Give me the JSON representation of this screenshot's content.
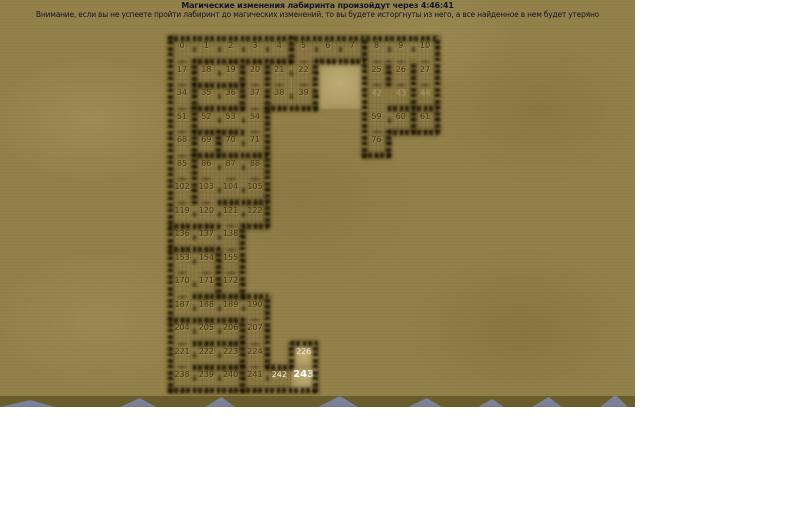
{
  "header": {
    "timer_line": "Магические изменения лабиринта произойдут через 4:46:41",
    "warning_line": "Внимание, если вы не успеете пройти лабиринт до магических изменений, то вы будете исторгнуты из него, а все найденное в нем будет утеряно"
  },
  "theme": {
    "sand": "#93814a",
    "light": "#ae9c64",
    "num": "#43350f",
    "faint": "#9c8a52",
    "wnum": "#efe9d6",
    "band": "#6a5d2c",
    "peak": "#7d85a8"
  },
  "maze": {
    "grid": {
      "origin_x": 170,
      "origin_y": 38,
      "cell_w": 24.3,
      "cell_h": 23.5,
      "cols": 11,
      "rows": 15
    },
    "light_areas": [
      {
        "r": 1,
        "c": 6,
        "w": 2,
        "h": 2
      },
      {
        "r": 13,
        "c": 5,
        "w": 1,
        "h": 1
      },
      {
        "r": 14,
        "c": 5,
        "w": 1,
        "h": 1
      }
    ],
    "cells": [
      {
        "n": "0",
        "r": 0,
        "c": 0,
        "s": "n"
      },
      {
        "n": "1",
        "r": 0,
        "c": 1,
        "s": "n"
      },
      {
        "n": "2",
        "r": 0,
        "c": 2,
        "s": "n"
      },
      {
        "n": "3",
        "r": 0,
        "c": 3,
        "s": "n"
      },
      {
        "n": "4",
        "r": 0,
        "c": 4,
        "s": "n"
      },
      {
        "n": "5",
        "r": 0,
        "c": 5,
        "s": "n"
      },
      {
        "n": "6",
        "r": 0,
        "c": 6,
        "s": "n"
      },
      {
        "n": "7",
        "r": 0,
        "c": 7,
        "s": "n"
      },
      {
        "n": "8",
        "r": 0,
        "c": 8,
        "s": "n"
      },
      {
        "n": "9",
        "r": 0,
        "c": 9,
        "s": "n"
      },
      {
        "n": "10",
        "r": 0,
        "c": 10,
        "s": "n"
      },
      {
        "n": "17",
        "r": 1,
        "c": 0,
        "s": "n"
      },
      {
        "n": "18",
        "r": 1,
        "c": 1,
        "s": "n"
      },
      {
        "n": "19",
        "r": 1,
        "c": 2,
        "s": "n"
      },
      {
        "n": "20",
        "r": 1,
        "c": 3,
        "s": "n"
      },
      {
        "n": "21",
        "r": 1,
        "c": 4,
        "s": "n"
      },
      {
        "n": "22",
        "r": 1,
        "c": 5,
        "s": "n"
      },
      {
        "n": "25",
        "r": 1,
        "c": 8,
        "s": "n"
      },
      {
        "n": "26",
        "r": 1,
        "c": 9,
        "s": "n"
      },
      {
        "n": "27",
        "r": 1,
        "c": 10,
        "s": "n"
      },
      {
        "n": "34",
        "r": 2,
        "c": 0,
        "s": "n"
      },
      {
        "n": "35",
        "r": 2,
        "c": 1,
        "s": "n"
      },
      {
        "n": "36",
        "r": 2,
        "c": 2,
        "s": "n"
      },
      {
        "n": "37",
        "r": 2,
        "c": 3,
        "s": "n"
      },
      {
        "n": "38",
        "r": 2,
        "c": 4,
        "s": "n"
      },
      {
        "n": "39",
        "r": 2,
        "c": 5,
        "s": "n"
      },
      {
        "n": "42",
        "r": 2,
        "c": 8,
        "s": "f"
      },
      {
        "n": "43",
        "r": 2,
        "c": 9,
        "s": "f"
      },
      {
        "n": "44",
        "r": 2,
        "c": 10,
        "s": "f"
      },
      {
        "n": "51",
        "r": 3,
        "c": 0,
        "s": "n"
      },
      {
        "n": "52",
        "r": 3,
        "c": 1,
        "s": "n"
      },
      {
        "n": "53",
        "r": 3,
        "c": 2,
        "s": "n"
      },
      {
        "n": "54",
        "r": 3,
        "c": 3,
        "s": "n"
      },
      {
        "n": "59",
        "r": 3,
        "c": 8,
        "s": "n"
      },
      {
        "n": "60",
        "r": 3,
        "c": 9,
        "s": "n"
      },
      {
        "n": "61",
        "r": 3,
        "c": 10,
        "s": "n"
      },
      {
        "n": "68",
        "r": 4,
        "c": 0,
        "s": "n"
      },
      {
        "n": "69",
        "r": 4,
        "c": 1,
        "s": "n"
      },
      {
        "n": "70",
        "r": 4,
        "c": 2,
        "s": "n"
      },
      {
        "n": "71",
        "r": 4,
        "c": 3,
        "s": "n"
      },
      {
        "n": "76",
        "r": 4,
        "c": 8,
        "s": "n"
      },
      {
        "n": "85",
        "r": 5,
        "c": 0,
        "s": "n"
      },
      {
        "n": "86",
        "r": 5,
        "c": 1,
        "s": "n"
      },
      {
        "n": "87",
        "r": 5,
        "c": 2,
        "s": "n"
      },
      {
        "n": "88",
        "r": 5,
        "c": 3,
        "s": "n"
      },
      {
        "n": "102",
        "r": 6,
        "c": 0,
        "s": "n"
      },
      {
        "n": "103",
        "r": 6,
        "c": 1,
        "s": "n"
      },
      {
        "n": "104",
        "r": 6,
        "c": 2,
        "s": "n"
      },
      {
        "n": "105",
        "r": 6,
        "c": 3,
        "s": "n"
      },
      {
        "n": "119",
        "r": 7,
        "c": 0,
        "s": "n"
      },
      {
        "n": "120",
        "r": 7,
        "c": 1,
        "s": "n"
      },
      {
        "n": "121",
        "r": 7,
        "c": 2,
        "s": "n"
      },
      {
        "n": "122",
        "r": 7,
        "c": 3,
        "s": "n"
      },
      {
        "n": "136",
        "r": 8,
        "c": 0,
        "s": "n"
      },
      {
        "n": "137",
        "r": 8,
        "c": 1,
        "s": "n"
      },
      {
        "n": "138",
        "r": 8,
        "c": 2,
        "s": "n"
      },
      {
        "n": "153",
        "r": 9,
        "c": 0,
        "s": "n"
      },
      {
        "n": "154",
        "r": 9,
        "c": 1,
        "s": "n"
      },
      {
        "n": "155",
        "r": 9,
        "c": 2,
        "s": "n"
      },
      {
        "n": "170",
        "r": 10,
        "c": 0,
        "s": "n"
      },
      {
        "n": "171",
        "r": 10,
        "c": 1,
        "s": "n"
      },
      {
        "n": "172",
        "r": 10,
        "c": 2,
        "s": "n"
      },
      {
        "n": "187",
        "r": 11,
        "c": 0,
        "s": "n"
      },
      {
        "n": "188",
        "r": 11,
        "c": 1,
        "s": "n"
      },
      {
        "n": "189",
        "r": 11,
        "c": 2,
        "s": "n"
      },
      {
        "n": "190",
        "r": 11,
        "c": 3,
        "s": "n"
      },
      {
        "n": "204",
        "r": 12,
        "c": 0,
        "s": "n"
      },
      {
        "n": "205",
        "r": 12,
        "c": 1,
        "s": "n"
      },
      {
        "n": "206",
        "r": 12,
        "c": 2,
        "s": "n"
      },
      {
        "n": "207",
        "r": 12,
        "c": 3,
        "s": "n"
      },
      {
        "n": "221",
        "r": 13,
        "c": 0,
        "s": "n"
      },
      {
        "n": "222",
        "r": 13,
        "c": 1,
        "s": "n"
      },
      {
        "n": "223",
        "r": 13,
        "c": 2,
        "s": "n"
      },
      {
        "n": "224",
        "r": 13,
        "c": 3,
        "s": "n"
      },
      {
        "n": "226",
        "r": 13,
        "c": 5,
        "s": "w"
      },
      {
        "n": "238",
        "r": 14,
        "c": 0,
        "s": "n"
      },
      {
        "n": "239",
        "r": 14,
        "c": 1,
        "s": "n"
      },
      {
        "n": "240",
        "r": 14,
        "c": 2,
        "s": "n"
      },
      {
        "n": "241",
        "r": 14,
        "c": 3,
        "s": "n"
      },
      {
        "n": "242",
        "r": 14,
        "c": 4,
        "s": "w"
      },
      {
        "n": "243",
        "r": 14,
        "c": 5,
        "s": "cur"
      }
    ],
    "walls": [
      {
        "t": "h",
        "r": 0,
        "c": 0,
        "len": 11
      },
      {
        "t": "v",
        "c": 0,
        "r": 0,
        "len": 15
      },
      {
        "t": "v",
        "c": 11,
        "r": 0,
        "len": 4
      },
      {
        "t": "h",
        "r": 15,
        "c": 0,
        "len": 6
      },
      {
        "t": "h",
        "r": 4,
        "c": 9,
        "len": 2
      },
      {
        "t": "v",
        "c": 9,
        "r": 4,
        "len": 1
      },
      {
        "t": "h",
        "r": 5,
        "c": 8,
        "len": 1
      },
      {
        "t": "v",
        "c": 8,
        "r": 0,
        "len": 5
      },
      {
        "t": "h",
        "r": 1,
        "c": 6,
        "len": 2
      },
      {
        "t": "v",
        "c": 6,
        "r": 1,
        "len": 2
      },
      {
        "t": "h",
        "r": 3,
        "c": 4,
        "len": 2
      },
      {
        "t": "v",
        "c": 4,
        "r": 3,
        "len": 5
      },
      {
        "t": "v",
        "c": 3,
        "r": 8,
        "len": 3
      },
      {
        "t": "h",
        "r": 8,
        "c": 3,
        "len": 1
      },
      {
        "t": "h",
        "r": 11,
        "c": 3,
        "len": 1
      },
      {
        "t": "v",
        "c": 4,
        "r": 11,
        "len": 3
      },
      {
        "t": "h",
        "r": 14,
        "c": 4,
        "len": 1
      },
      {
        "t": "h",
        "r": 13,
        "c": 5,
        "len": 1
      },
      {
        "t": "v",
        "c": 5,
        "r": 13,
        "len": 1
      },
      {
        "t": "v",
        "c": 6,
        "r": 13,
        "len": 2
      },
      {
        "t": "h",
        "r": 1,
        "c": 1,
        "len": 4
      },
      {
        "t": "v",
        "c": 1,
        "r": 1,
        "len": 2
      },
      {
        "t": "v",
        "c": 3,
        "r": 1,
        "len": 2
      },
      {
        "t": "v",
        "c": 4,
        "r": 1,
        "len": 2
      },
      {
        "t": "h",
        "r": 2,
        "c": 1,
        "len": 2
      },
      {
        "t": "h",
        "r": 3,
        "c": 1,
        "len": 2
      },
      {
        "t": "v",
        "c": 5,
        "r": 0,
        "len": 1
      },
      {
        "t": "v",
        "c": 10,
        "r": 1,
        "len": 3
      },
      {
        "t": "v",
        "c": 9,
        "r": 1,
        "len": 1
      },
      {
        "t": "h",
        "r": 3,
        "c": 9,
        "len": 2
      },
      {
        "t": "v",
        "c": 1,
        "r": 3,
        "len": 2
      },
      {
        "t": "h",
        "r": 4,
        "c": 1,
        "len": 2
      },
      {
        "t": "v",
        "c": 2,
        "r": 4,
        "len": 1
      },
      {
        "t": "h",
        "r": 5,
        "c": 1,
        "len": 3
      },
      {
        "t": "v",
        "c": 1,
        "r": 5,
        "len": 2
      },
      {
        "t": "h",
        "r": 7,
        "c": 2,
        "len": 2
      },
      {
        "t": "h",
        "r": 8,
        "c": 0,
        "len": 2
      },
      {
        "t": "h",
        "r": 9,
        "c": 0,
        "len": 2
      },
      {
        "t": "v",
        "c": 2,
        "r": 9,
        "len": 2
      },
      {
        "t": "h",
        "r": 11,
        "c": 1,
        "len": 2
      },
      {
        "t": "h",
        "r": 12,
        "c": 0,
        "len": 3
      },
      {
        "t": "h",
        "r": 13,
        "c": 1,
        "len": 2
      },
      {
        "t": "v",
        "c": 3,
        "r": 12,
        "len": 2
      },
      {
        "t": "h",
        "r": 14,
        "c": 1,
        "len": 2
      },
      {
        "t": "v",
        "c": 3,
        "r": 14,
        "len": 1
      }
    ]
  },
  "footer": {
    "peaks": [
      {
        "x": 0,
        "w": 55,
        "h": 7
      },
      {
        "x": 120,
        "w": 36,
        "h": 9
      },
      {
        "x": 205,
        "w": 30,
        "h": 10
      },
      {
        "x": 318,
        "w": 40,
        "h": 11
      },
      {
        "x": 408,
        "w": 34,
        "h": 9
      },
      {
        "x": 478,
        "w": 26,
        "h": 8
      },
      {
        "x": 532,
        "w": 30,
        "h": 10
      },
      {
        "x": 600,
        "w": 28,
        "h": 12
      }
    ]
  }
}
